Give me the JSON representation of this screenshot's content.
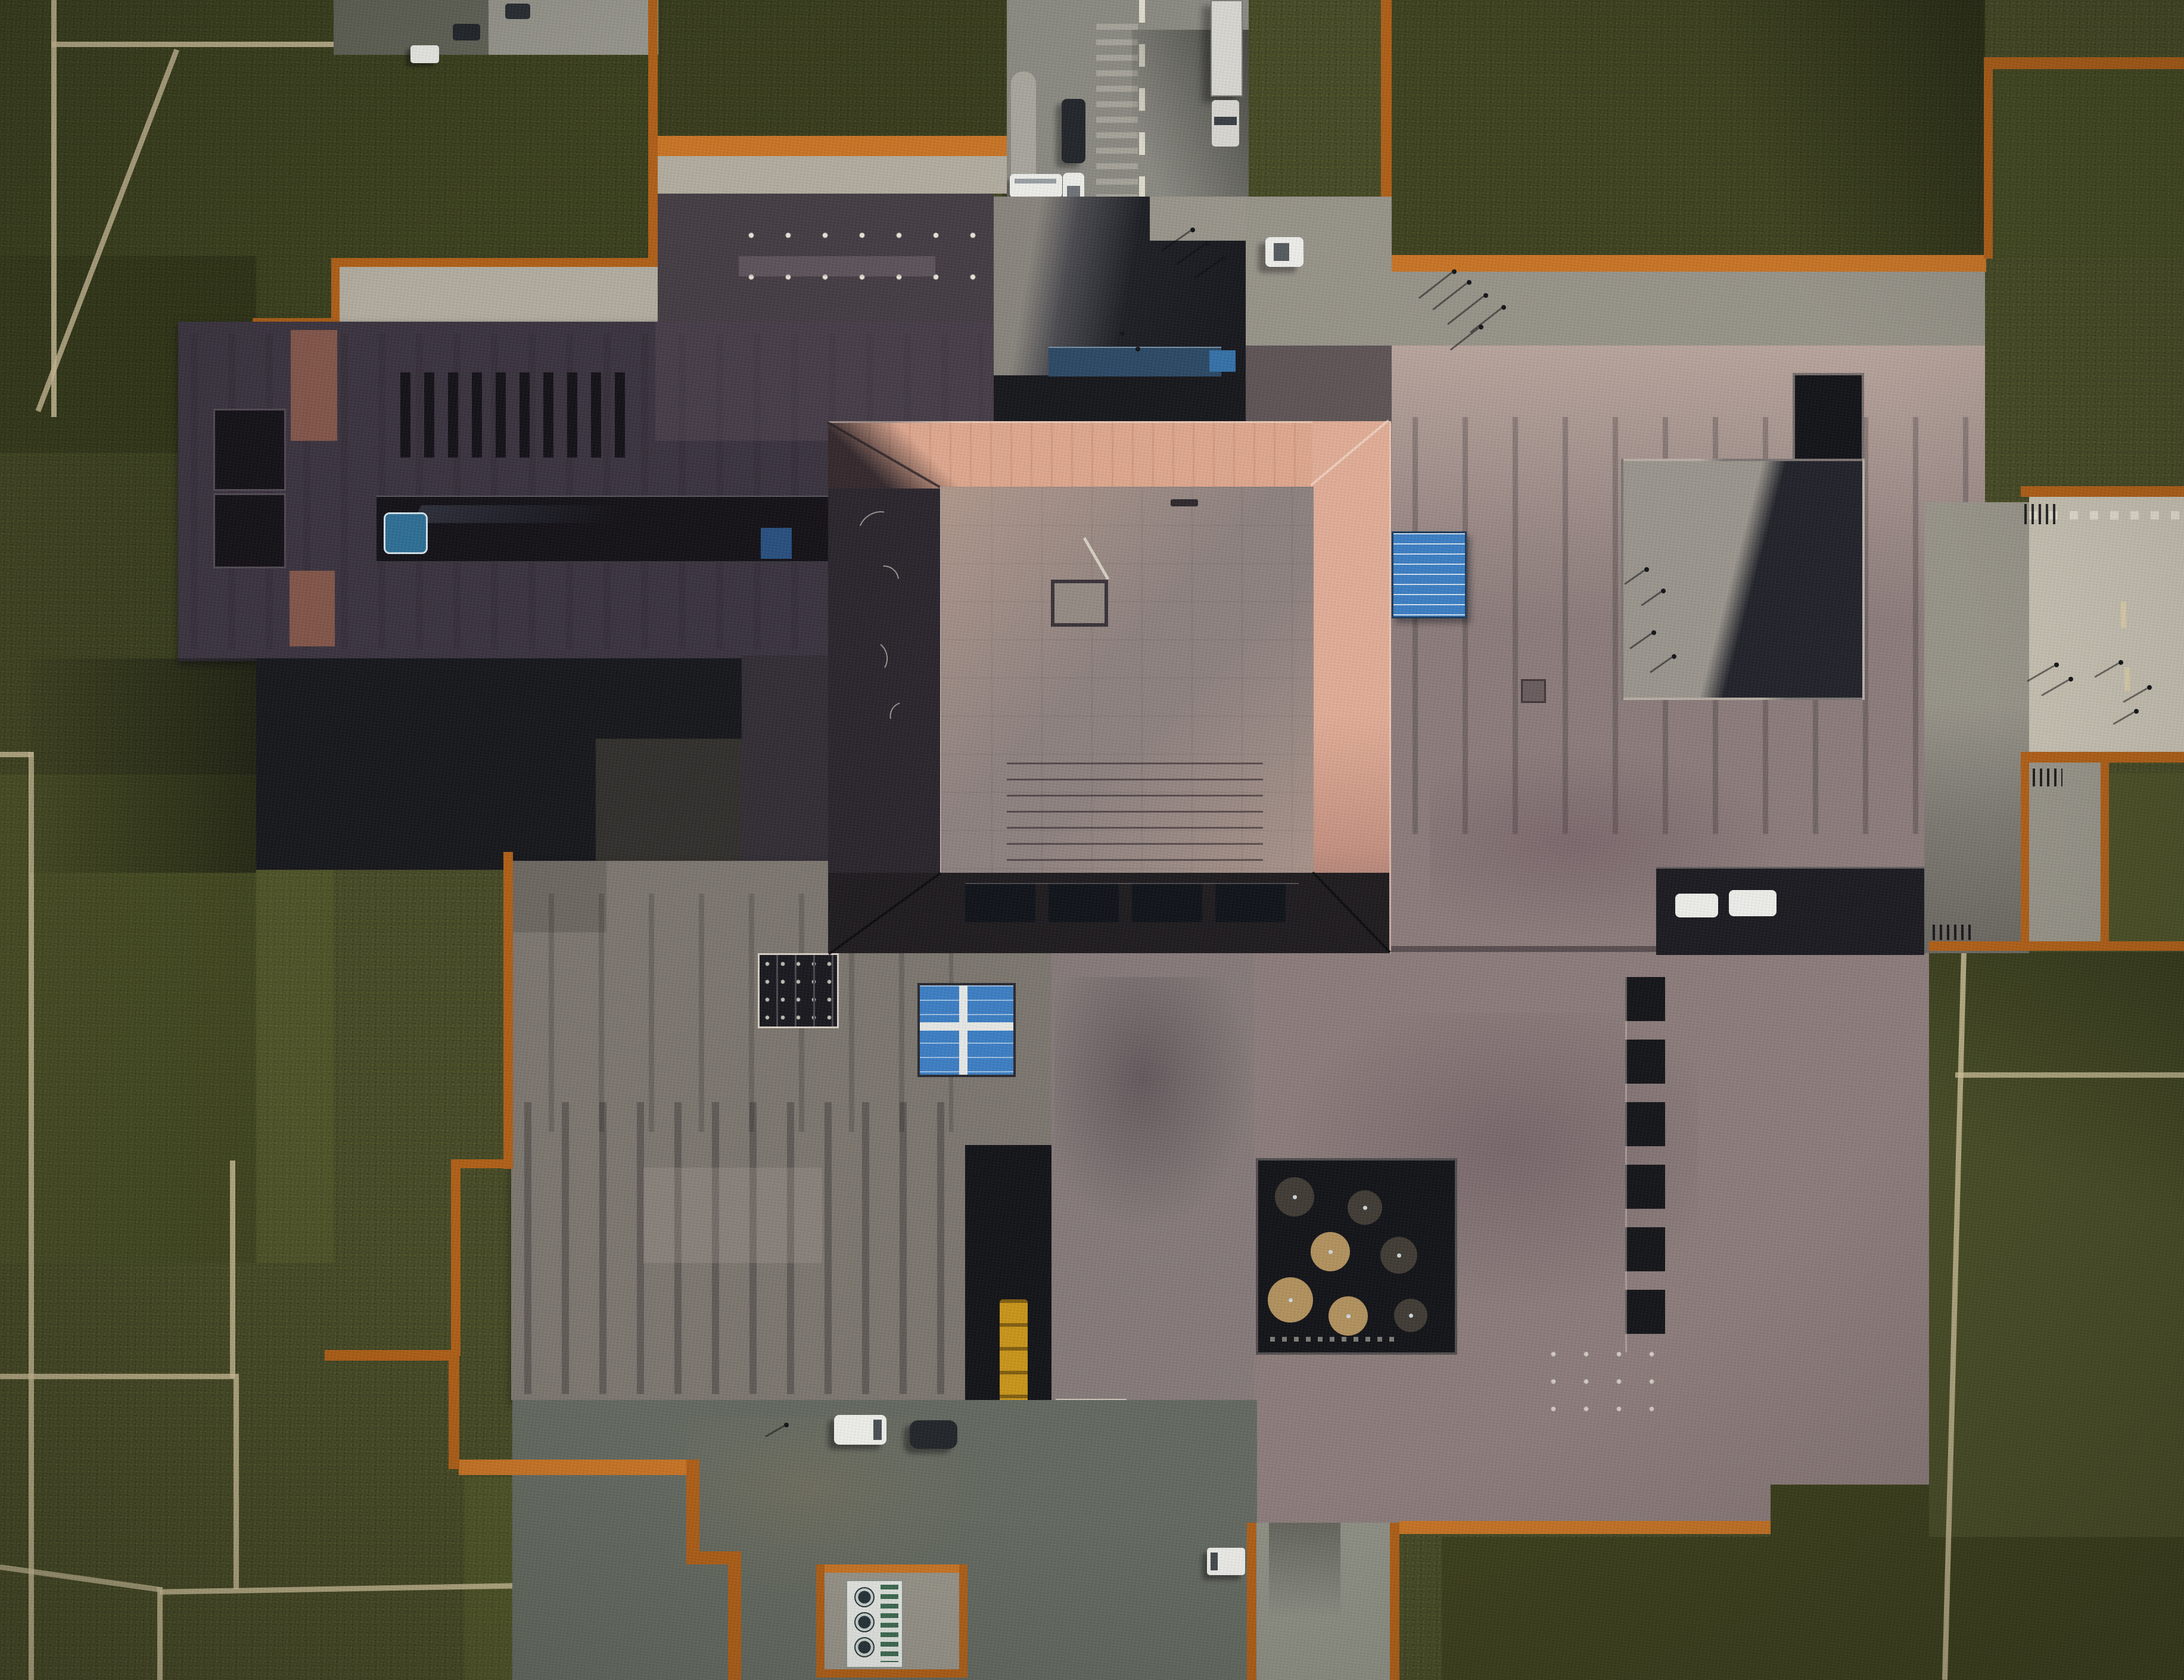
{
  "scene": {
    "type": "aerial-photograph",
    "subject": "top-down drone view of a large museum building complex under construction",
    "setting": "dark olive lawns crossed by pale footpaths, corten-steel edged terraces, concrete plazas and roads",
    "landmarks": [
      "central square pavilion with pink sunlit hip roof",
      "charcoal north-west wing with roof vent slots and glazed trench",
      "grey plank-roof south-west wing",
      "large mauve east wing with sunken courtyards",
      "bright blue skylight panels",
      "sunken tree courtyard with seven round canopies",
      "north access road with dashed centre line",
      "east pedestrian walkway between corten walls"
    ]
  },
  "palette": {
    "grass_base": "#464a26",
    "grass_dark": "#3c401d",
    "grass_mid": "#494e27",
    "grass_light": "#565c2d",
    "grass_ne": "#4b5128",
    "path_tan": "#cfc19b",
    "corten": "#b06018",
    "corten_bright": "#c97526",
    "asphalt": "#8b8a83",
    "asphalt_light": "#98978e",
    "concrete_weathered": "#b2ad9f",
    "concrete_light": "#c6c1b2",
    "concrete_mid": "#98948a",
    "concrete_blue": "#646a61",
    "concrete_path": "#8f9186",
    "charcoal": "#3b3440",
    "charcoal_light": "#453d44",
    "charcoal_deep": "#332e36",
    "accent_brown": "#8c5a4b",
    "slot_dark": "#141218",
    "plank_gray": "#7d7770",
    "plank_gray_dark": "#6e6862",
    "mauve": "#8d7d7c",
    "mauve_dark": "#5f5557",
    "mauve_deep": "#877b7a",
    "pink_light": "#c6b1a8",
    "pink_pale": "#cdb9af",
    "pavilion_pink": "#dfa88f",
    "pavilion_flat": "#8f8381",
    "eave_dark": "#2b262d",
    "eave_south": "#201d20",
    "court_dark": "#17181d",
    "court_black": "#131419",
    "notch_dark": "#1d1c22",
    "blue_sky": "#3d7fc4",
    "blue_glass": "#2c4a66",
    "blue_deep": "#2a5080",
    "blue_obj": "#2f6f95",
    "white_paint": "#e9e5d9",
    "veh_white": "#eeeeea",
    "veh_dark": "#23272c",
    "veh_yellow": "#c9961c",
    "tree_tan": "#b3925f",
    "tree_dark": "#413c35"
  },
  "objects": {
    "vehicles": [
      {
        "name": "dark sedan on north road",
        "color": "#23272c"
      },
      {
        "name": "white sedan on north road",
        "color": "#eeeeea"
      },
      {
        "name": "truck with trailer at road top",
        "color": "#d8d7d2"
      },
      {
        "name": "white hatchback east of road",
        "color": "#eeeeea"
      },
      {
        "name": "white shuttle bus at junction",
        "color": "#eeeeea"
      },
      {
        "name": "white van top-left road",
        "color": "#eeeeea"
      },
      {
        "name": "dark car top-left road",
        "color": "#23272c"
      },
      {
        "name": "second dark car top-left",
        "color": "#2a2e33"
      },
      {
        "name": "white van on south apron",
        "color": "#eeeeea"
      },
      {
        "name": "dark car on south apron",
        "color": "#23272c"
      },
      {
        "name": "yellow articulated truck in service slot",
        "color": "#c9961c"
      },
      {
        "name": "white box truck near south path",
        "color": "#eeeeea"
      },
      {
        "name": "white car in east parking notch 1",
        "color": "#eeeeea"
      },
      {
        "name": "white car in east parking notch 2",
        "color": "#eeeeea"
      }
    ],
    "people_groups": [
      {
        "name": "visitors on north plaza",
        "count": 5
      },
      {
        "name": "pedestrians at road junction",
        "count": 3
      },
      {
        "name": "walkers on east walkway",
        "count": 5
      },
      {
        "name": "people in north-east courtyard",
        "count": 4
      },
      {
        "name": "figures in entry canyon",
        "count": 2
      },
      {
        "name": "worker near south apron",
        "count": 1
      }
    ],
    "features": [
      {
        "name": "hvac-pit",
        "desc": "corten framed pit with white chiller and three fans"
      },
      {
        "name": "blue-skylight-east",
        "desc": "blue louvred panel east of pavilion"
      },
      {
        "name": "blue-skylight-south",
        "desc": "blue four-pane glazed grid on south roof"
      },
      {
        "name": "tree-courtyard",
        "desc": "seven round canopies in dark sunken court"
      },
      {
        "name": "stair-slot-column",
        "desc": "column of six dark roof slots"
      },
      {
        "name": "roof-vent-slots",
        "desc": "row of ten slots on charcoal wing"
      }
    ]
  }
}
